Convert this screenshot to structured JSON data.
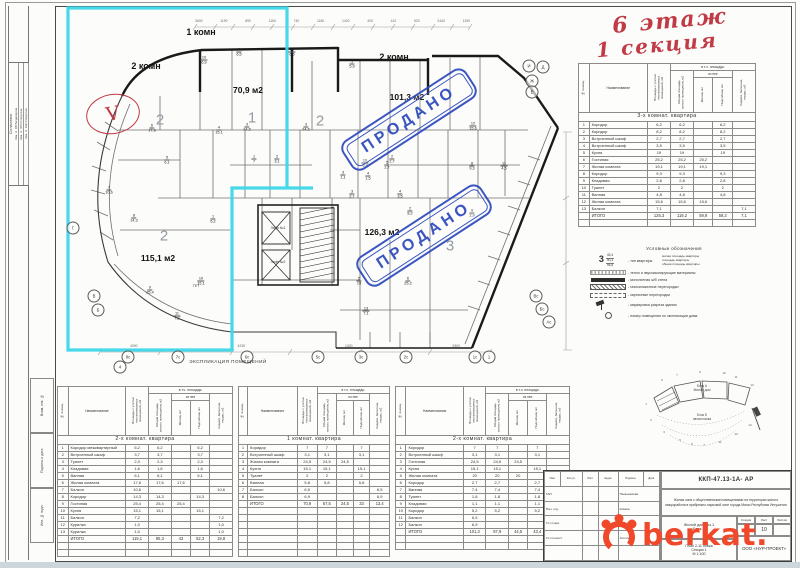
{
  "annotations": {
    "floor": "6 этаж",
    "section": "1 секция",
    "check": "V"
  },
  "stamps": {
    "sold": "ПРОДАНО",
    "color": "#2b48bd"
  },
  "explication_heading": "ЭКСПЛИКАЦИЯ ПОМЕЩЕНИЙ",
  "plan": {
    "type_labels": [
      {
        "t": "2 комн",
        "x": 146,
        "y": 66
      },
      {
        "t": "1 комн",
        "x": 201,
        "y": 32
      },
      {
        "t": "2 комн",
        "x": 394,
        "y": 57
      }
    ],
    "area_labels": [
      {
        "t": "70,9 м2",
        "x": 248,
        "y": 90
      },
      {
        "t": "101,3 м2",
        "x": 407,
        "y": 97
      },
      {
        "t": "115,1 м2",
        "x": 158,
        "y": 258
      },
      {
        "t": "126,3 м2",
        "x": 382,
        "y": 232
      }
    ],
    "apt_numbers": [
      {
        "n": "2",
        "x": 160,
        "y": 120
      },
      {
        "n": "1",
        "x": 252,
        "y": 118
      },
      {
        "n": "2",
        "x": 320,
        "y": 121
      },
      {
        "n": "2",
        "x": 164,
        "y": 236
      },
      {
        "n": "3",
        "x": 450,
        "y": 246
      }
    ],
    "room_labels": [
      {
        "n": "6",
        "a": "17,6",
        "x": 152,
        "y": 128
      },
      {
        "n": "5",
        "a": "6,1",
        "x": 167,
        "y": 160
      },
      {
        "n": "7",
        "a": "10,6",
        "x": 109,
        "y": 190
      },
      {
        "n": "8",
        "a": "14,3",
        "x": 134,
        "y": 218
      },
      {
        "n": "9",
        "a": "25,4",
        "x": 150,
        "y": 290
      },
      {
        "n": "10",
        "a": "15,1",
        "x": 201,
        "y": 281
      },
      {
        "n": "11",
        "a": "7,2",
        "x": 177,
        "y": 316
      },
      {
        "n": "1",
        "a": "6,2",
        "x": 213,
        "y": 219
      },
      {
        "n": "10",
        "a": "6,9",
        "x": 204,
        "y": 60
      },
      {
        "n": "9",
        "a": "6,5",
        "x": 239,
        "y": 52
      },
      {
        "n": "12",
        "a": "6,5",
        "x": 292,
        "y": 52
      },
      {
        "n": "3",
        "a": "24,5",
        "x": 247,
        "y": 127
      },
      {
        "n": "4",
        "a": "15,1",
        "x": 219,
        "y": 130
      },
      {
        "n": "1",
        "a": "7",
        "x": 254,
        "y": 159
      },
      {
        "n": "2",
        "a": "3,1",
        "x": 277,
        "y": 159
      },
      {
        "n": "1",
        "a": "5,9",
        "x": 352,
        "y": 64
      },
      {
        "n": "3",
        "a": "24,5",
        "x": 306,
        "y": 127
      },
      {
        "n": "12",
        "a": "15,6",
        "x": 473,
        "y": 126
      },
      {
        "n": "8",
        "a": "9,3",
        "x": 472,
        "y": 166
      },
      {
        "n": "11",
        "a": "4,5",
        "x": 504,
        "y": 166
      },
      {
        "n": "10",
        "a": "5,2",
        "x": 365,
        "y": 163
      },
      {
        "n": "5",
        "a": "2,7",
        "x": 387,
        "y": 165
      },
      {
        "n": "3",
        "a": "1,1",
        "x": 343,
        "y": 175
      },
      {
        "n": "4",
        "a": "1,5",
        "x": 368,
        "y": 176
      },
      {
        "n": "3",
        "a": "2,7",
        "x": 352,
        "y": 194
      },
      {
        "n": "4",
        "a": "3,5",
        "x": 400,
        "y": 194
      },
      {
        "n": "2",
        "a": "8,2",
        "x": 410,
        "y": 211
      },
      {
        "n": "9",
        "a": "2,9",
        "x": 472,
        "y": 213
      },
      {
        "n": "5",
        "a": "19",
        "x": 359,
        "y": 281
      },
      {
        "n": "6",
        "a": "25,2",
        "x": 408,
        "y": 281
      },
      {
        "n": "13",
        "a": "7,1",
        "x": 366,
        "y": 311
      },
      {
        "n": "2",
        "a": "2,7",
        "x": 392,
        "y": 159
      }
    ],
    "core_labels": [
      {
        "t": "Лифт №1",
        "x": 278,
        "y": 228
      },
      {
        "t": "Лифт №2",
        "x": 278,
        "y": 262
      },
      {
        "t": "ТЕТ",
        "x": 196,
        "y": 286
      }
    ],
    "bubbles": [
      {
        "t": "8с",
        "x": 128,
        "y": 357
      },
      {
        "t": "7с",
        "x": 178,
        "y": 357
      },
      {
        "t": "6с",
        "x": 247,
        "y": 357
      },
      {
        "t": "5с",
        "x": 318,
        "y": 357
      },
      {
        "t": "3с",
        "x": 361,
        "y": 357
      },
      {
        "t": "2с",
        "x": 406,
        "y": 357
      },
      {
        "t": "1с",
        "x": 475,
        "y": 357
      },
      {
        "t": "1",
        "x": 489,
        "y": 357
      },
      {
        "t": "4",
        "x": 120,
        "y": 367
      },
      {
        "t": "И",
        "x": 529,
        "y": 66
      },
      {
        "t": "Д",
        "x": 543,
        "y": 67
      },
      {
        "t": "Ж",
        "x": 532,
        "y": 81
      },
      {
        "t": "Е",
        "x": 532,
        "y": 92
      },
      {
        "t": "Вс",
        "x": 536,
        "y": 296
      },
      {
        "t": "Бс",
        "x": 542,
        "y": 309
      },
      {
        "t": "Ас",
        "x": 549,
        "y": 322
      },
      {
        "t": "Г",
        "x": 73,
        "y": 228
      },
      {
        "t": "В",
        "x": 94,
        "y": 296
      },
      {
        "t": "Б",
        "x": 98,
        "y": 310
      }
    ],
    "dim_top": [
      "3600",
      "1190",
      "890",
      "1160",
      "740",
      "1180",
      "1420",
      "400",
      "410",
      "520",
      "2440",
      "1190"
    ],
    "dim_bottom": [
      "4090",
      "4235",
      "1300",
      "5300"
    ]
  },
  "table_headers": {
    "num": "№ помещ.",
    "name": "Наименование",
    "total_area": "Площадь с учетом неотапливаемых помещений, м2",
    "span_incl": "в т.ч. площадь:",
    "living_total": "Общая площадь жилого помещения, м2",
    "span_of": "из нее",
    "living": "Жилая, м2",
    "aux": "Подсобная, м2",
    "balcony": "Лоджий, балконов, террас, м2",
    "total_label": "ИТОГО"
  },
  "tables": {
    "apt3": {
      "title": "3-х комнат. квартира",
      "empty": 1,
      "rows": [
        [
          "1",
          "Коридор",
          "6,2",
          "6,2",
          "",
          "6,2",
          ""
        ],
        [
          "2",
          "Коридор",
          "8,2",
          "8,2",
          "",
          "8,2",
          ""
        ],
        [
          "3",
          "Встроенный шкаф",
          "2,7",
          "2,7",
          "",
          "2,7",
          ""
        ],
        [
          "4",
          "Встроенный шкаф",
          "3,5",
          "3,5",
          "",
          "3,5",
          ""
        ],
        [
          "5",
          "Кухня",
          "19",
          "19",
          "",
          "19",
          ""
        ],
        [
          "6",
          "Гостиная",
          "25,2",
          "25,2",
          "25,2",
          "",
          ""
        ],
        [
          "7",
          "Жилая комната",
          "19,1",
          "19,1",
          "19,1",
          "",
          ""
        ],
        [
          "8",
          "Коридор",
          "9,3",
          "9,3",
          "",
          "9,3",
          ""
        ],
        [
          "9",
          "Кладовая",
          "2,8",
          "2,8",
          "",
          "2,8",
          ""
        ],
        [
          "10",
          "Туалет",
          "2",
          "2",
          "",
          "2",
          ""
        ],
        [
          "11",
          "Ванная",
          "4,8",
          "4,8",
          "",
          "4,8",
          ""
        ],
        [
          "12",
          "Жилая комната",
          "15,6",
          "15,6",
          "15,6",
          "",
          ""
        ],
        [
          "13",
          "Балкон",
          "7,1",
          "",
          "",
          "",
          "7,1"
        ]
      ],
      "total": [
        "",
        "ИТОГО",
        "126,3",
        "119,2",
        "59,9",
        "59,3",
        "7,1"
      ]
    },
    "apt2_left": {
      "title": "2-х комнат. квартира",
      "empty": 2,
      "rows": [
        [
          "1",
          "Коридор межквартирный",
          "6,2",
          "6,2",
          "",
          "6,2",
          ""
        ],
        [
          "2",
          "Встроенный шкаф",
          "3,7",
          "3,7",
          "",
          "3,7",
          ""
        ],
        [
          "3",
          "Туалет",
          "2,3",
          "2,3",
          "",
          "2,3",
          ""
        ],
        [
          "4",
          "Кладовая",
          "1,6",
          "1,6",
          "",
          "1,6",
          ""
        ],
        [
          "5",
          "Ванная",
          "6,1",
          "6,1",
          "",
          "6,1",
          ""
        ],
        [
          "6",
          "Жилая комната",
          "17,6",
          "17,6",
          "17,6",
          "",
          ""
        ],
        [
          "7",
          "Балкон",
          "10,6",
          "",
          "",
          "",
          "10,6"
        ],
        [
          "8",
          "Коридор",
          "14,3",
          "14,3",
          "",
          "14,3",
          ""
        ],
        [
          "9",
          "Гостиная",
          "25,4",
          "25,4",
          "25,4",
          "",
          ""
        ],
        [
          "10",
          "Кухня",
          "15,1",
          "15,1",
          "",
          "15,1",
          ""
        ],
        [
          "11",
          "Балкон",
          "7,2",
          "",
          "",
          "",
          "7,2"
        ],
        [
          "12",
          "Курилка",
          "1,0",
          "",
          "",
          "",
          "1,0"
        ],
        [
          "13",
          "Курилка",
          "1,0",
          "",
          "",
          "",
          "1,0"
        ]
      ],
      "total": [
        "",
        "ИТОГО",
        "115,1",
        "95,3",
        "43",
        "52,3",
        "19,8"
      ]
    },
    "apt1": {
      "title": "1 комнат. квартира",
      "empty": 7,
      "rows": [
        [
          "1",
          "Коридор",
          "7",
          "7",
          "",
          "7",
          ""
        ],
        [
          "2",
          "Встроенный шкаф",
          "3,1",
          "3,1",
          "",
          "3,1",
          ""
        ],
        [
          "3",
          "Жилая комната",
          "24,5",
          "24,5",
          "24,5",
          "",
          ""
        ],
        [
          "4",
          "Кухня",
          "15,1",
          "15,1",
          "",
          "15,1",
          ""
        ],
        [
          "5",
          "Туалет",
          "2",
          "2",
          "",
          "2",
          ""
        ],
        [
          "6",
          "Ванная",
          "5,8",
          "5,8",
          "",
          "5,8",
          ""
        ],
        [
          "7",
          "Балкон",
          "6,5",
          "",
          "",
          "",
          "6,5"
        ],
        [
          "8",
          "Балкон",
          "6,9",
          "",
          "",
          "",
          "6,9"
        ]
      ],
      "total": [
        "",
        "ИТОГО",
        "70,9",
        "57,5",
        "24,5",
        "33",
        "13,4"
      ]
    },
    "apt2_right": {
      "title": "2-х комнат. квартира",
      "empty": 2,
      "rows": [
        [
          "1",
          "Коридор",
          "7",
          "7",
          "",
          "7",
          ""
        ],
        [
          "2",
          "Встроенный шкаф",
          "3,1",
          "3,1",
          "",
          "3,1",
          ""
        ],
        [
          "3",
          "Гостиная",
          "24,5",
          "24,5",
          "24,5",
          "",
          ""
        ],
        [
          "4",
          "Кухня",
          "15,1",
          "15,1",
          "",
          "15,1",
          ""
        ],
        [
          "5",
          "Жилая комната",
          "20",
          "20",
          "20",
          "",
          ""
        ],
        [
          "6",
          "Коридор",
          "2,7",
          "2,7",
          "",
          "2,7",
          ""
        ],
        [
          "7",
          "Ванная",
          "7,4",
          "7,4",
          "",
          "7,4",
          ""
        ],
        [
          "8",
          "Туалет",
          "1,8",
          "1,8",
          "",
          "1,8",
          ""
        ],
        [
          "9",
          "Кладовая",
          "1,1",
          "1,1",
          "",
          "1,1",
          ""
        ],
        [
          "10",
          "Коридор",
          "5,2",
          "5,2",
          "",
          "5,2",
          ""
        ],
        [
          "11",
          "Балкон",
          "6,5",
          "",
          "",
          "",
          "6,5"
        ],
        [
          "12",
          "Балкон",
          "6,9",
          "",
          "",
          "",
          "6,9"
        ]
      ],
      "total": [
        "",
        "ИТОГО",
        "101,3",
        "87,9",
        "44,5",
        "43,4",
        "13,4"
      ]
    }
  },
  "legend": {
    "title": "Условные обозначения",
    "type_symbol": {
      "big": "3",
      "values": [
        "43,4",
        "90,3",
        "95,8"
      ],
      "caption": "- тип квартиры",
      "labels": [
        "жилая площадь квартиры",
        "площадь квартиры",
        "общая площадь квартиры"
      ]
    },
    "items": [
      {
        "sym": "insul",
        "text": "- тепло и звукоизолирующие материалы"
      },
      {
        "sym": "solid",
        "text": "- монолитная ж/б стена"
      },
      {
        "sym": "hatch",
        "text": "- газосиликатные перегородки"
      },
      {
        "sym": "dash",
        "text": "- кирпичные перегородки"
      },
      {
        "sym": "flag",
        "text": "- маркировка разреза здания"
      },
      {
        "sym": "num",
        "text": "- номер помещения по экспликации дома"
      }
    ]
  },
  "keyplan": {
    "block_a": "Блок А",
    "block_a2": "Жилой дом",
    "block_b": "Блок Б",
    "block_b2": "автостоянка",
    "ticks": [
      {
        "t": "6",
        "x": 30,
        "y": 20
      },
      {
        "t": "7",
        "x": 45,
        "y": 15
      },
      {
        "t": "9",
        "x": 68,
        "y": 12
      },
      {
        "t": "10",
        "x": 92,
        "y": 13
      },
      {
        "t": "11",
        "x": 104,
        "y": 17
      },
      {
        "t": "13",
        "x": 120,
        "y": 25
      },
      {
        "t": "1",
        "x": 14,
        "y": 44
      },
      {
        "t": "2",
        "x": 19,
        "y": 60
      },
      {
        "t": "3",
        "x": 32,
        "y": 72
      },
      {
        "t": "5",
        "x": 48,
        "y": 80
      },
      {
        "t": "6",
        "x": 60,
        "y": 84
      },
      {
        "t": "7",
        "x": 72,
        "y": 85
      },
      {
        "t": "11",
        "x": 88,
        "y": 82
      },
      {
        "t": "13",
        "x": 104,
        "y": 74
      },
      {
        "t": "14",
        "x": 118,
        "y": 65
      }
    ]
  },
  "title_block": {
    "code": "ККП-47.13-1А- АР",
    "project": "Жилая зона с общественными помещениями на территории жилого микрорайона в прибрежно-парковой зоне города Магас Республики Ингушетия",
    "object": "Жилой дом поз.1",
    "block": "Блок А",
    "sheet_name": "План 2-11 этажа",
    "section": "Секция 1",
    "scale": "М 1:100",
    "stage_label": "Стадия",
    "sheet_label": "Лист",
    "sheets_label": "Листов",
    "stage": "Р",
    "sheet": "10",
    "sheets": "",
    "company": "ООО «НУР-ПРОЕКТ»",
    "sig_cols": [
      "Изм.",
      "Кол.уч.",
      "Лист",
      "№док.",
      "Подпись",
      "Дата"
    ],
    "signatures": [
      {
        "role": "ГАП",
        "name": "Пальчевская"
      },
      {
        "role": "Нач. отд.",
        "name": "Коваль"
      },
      {
        "role": "Гл.сп.арх.",
        "name": "Коваль"
      },
      {
        "role": "Гл.сп.конст.",
        "name": "Хохлова"
      }
    ]
  },
  "frame": {
    "agreed": "Согласовано",
    "agreed_rows": [
      "Зам. гл. ОВ   Багдасарова",
      "Зам. гл. ЭТО   Спекулова",
      "Зам. гл. АиК   Спекулова"
    ],
    "stamp_col": [
      "Взам. инв. №",
      "Подпись и дата",
      "Инв. № подл."
    ]
  },
  "watermark": {
    "text": "berkat.",
    "color": "#f0482a"
  }
}
